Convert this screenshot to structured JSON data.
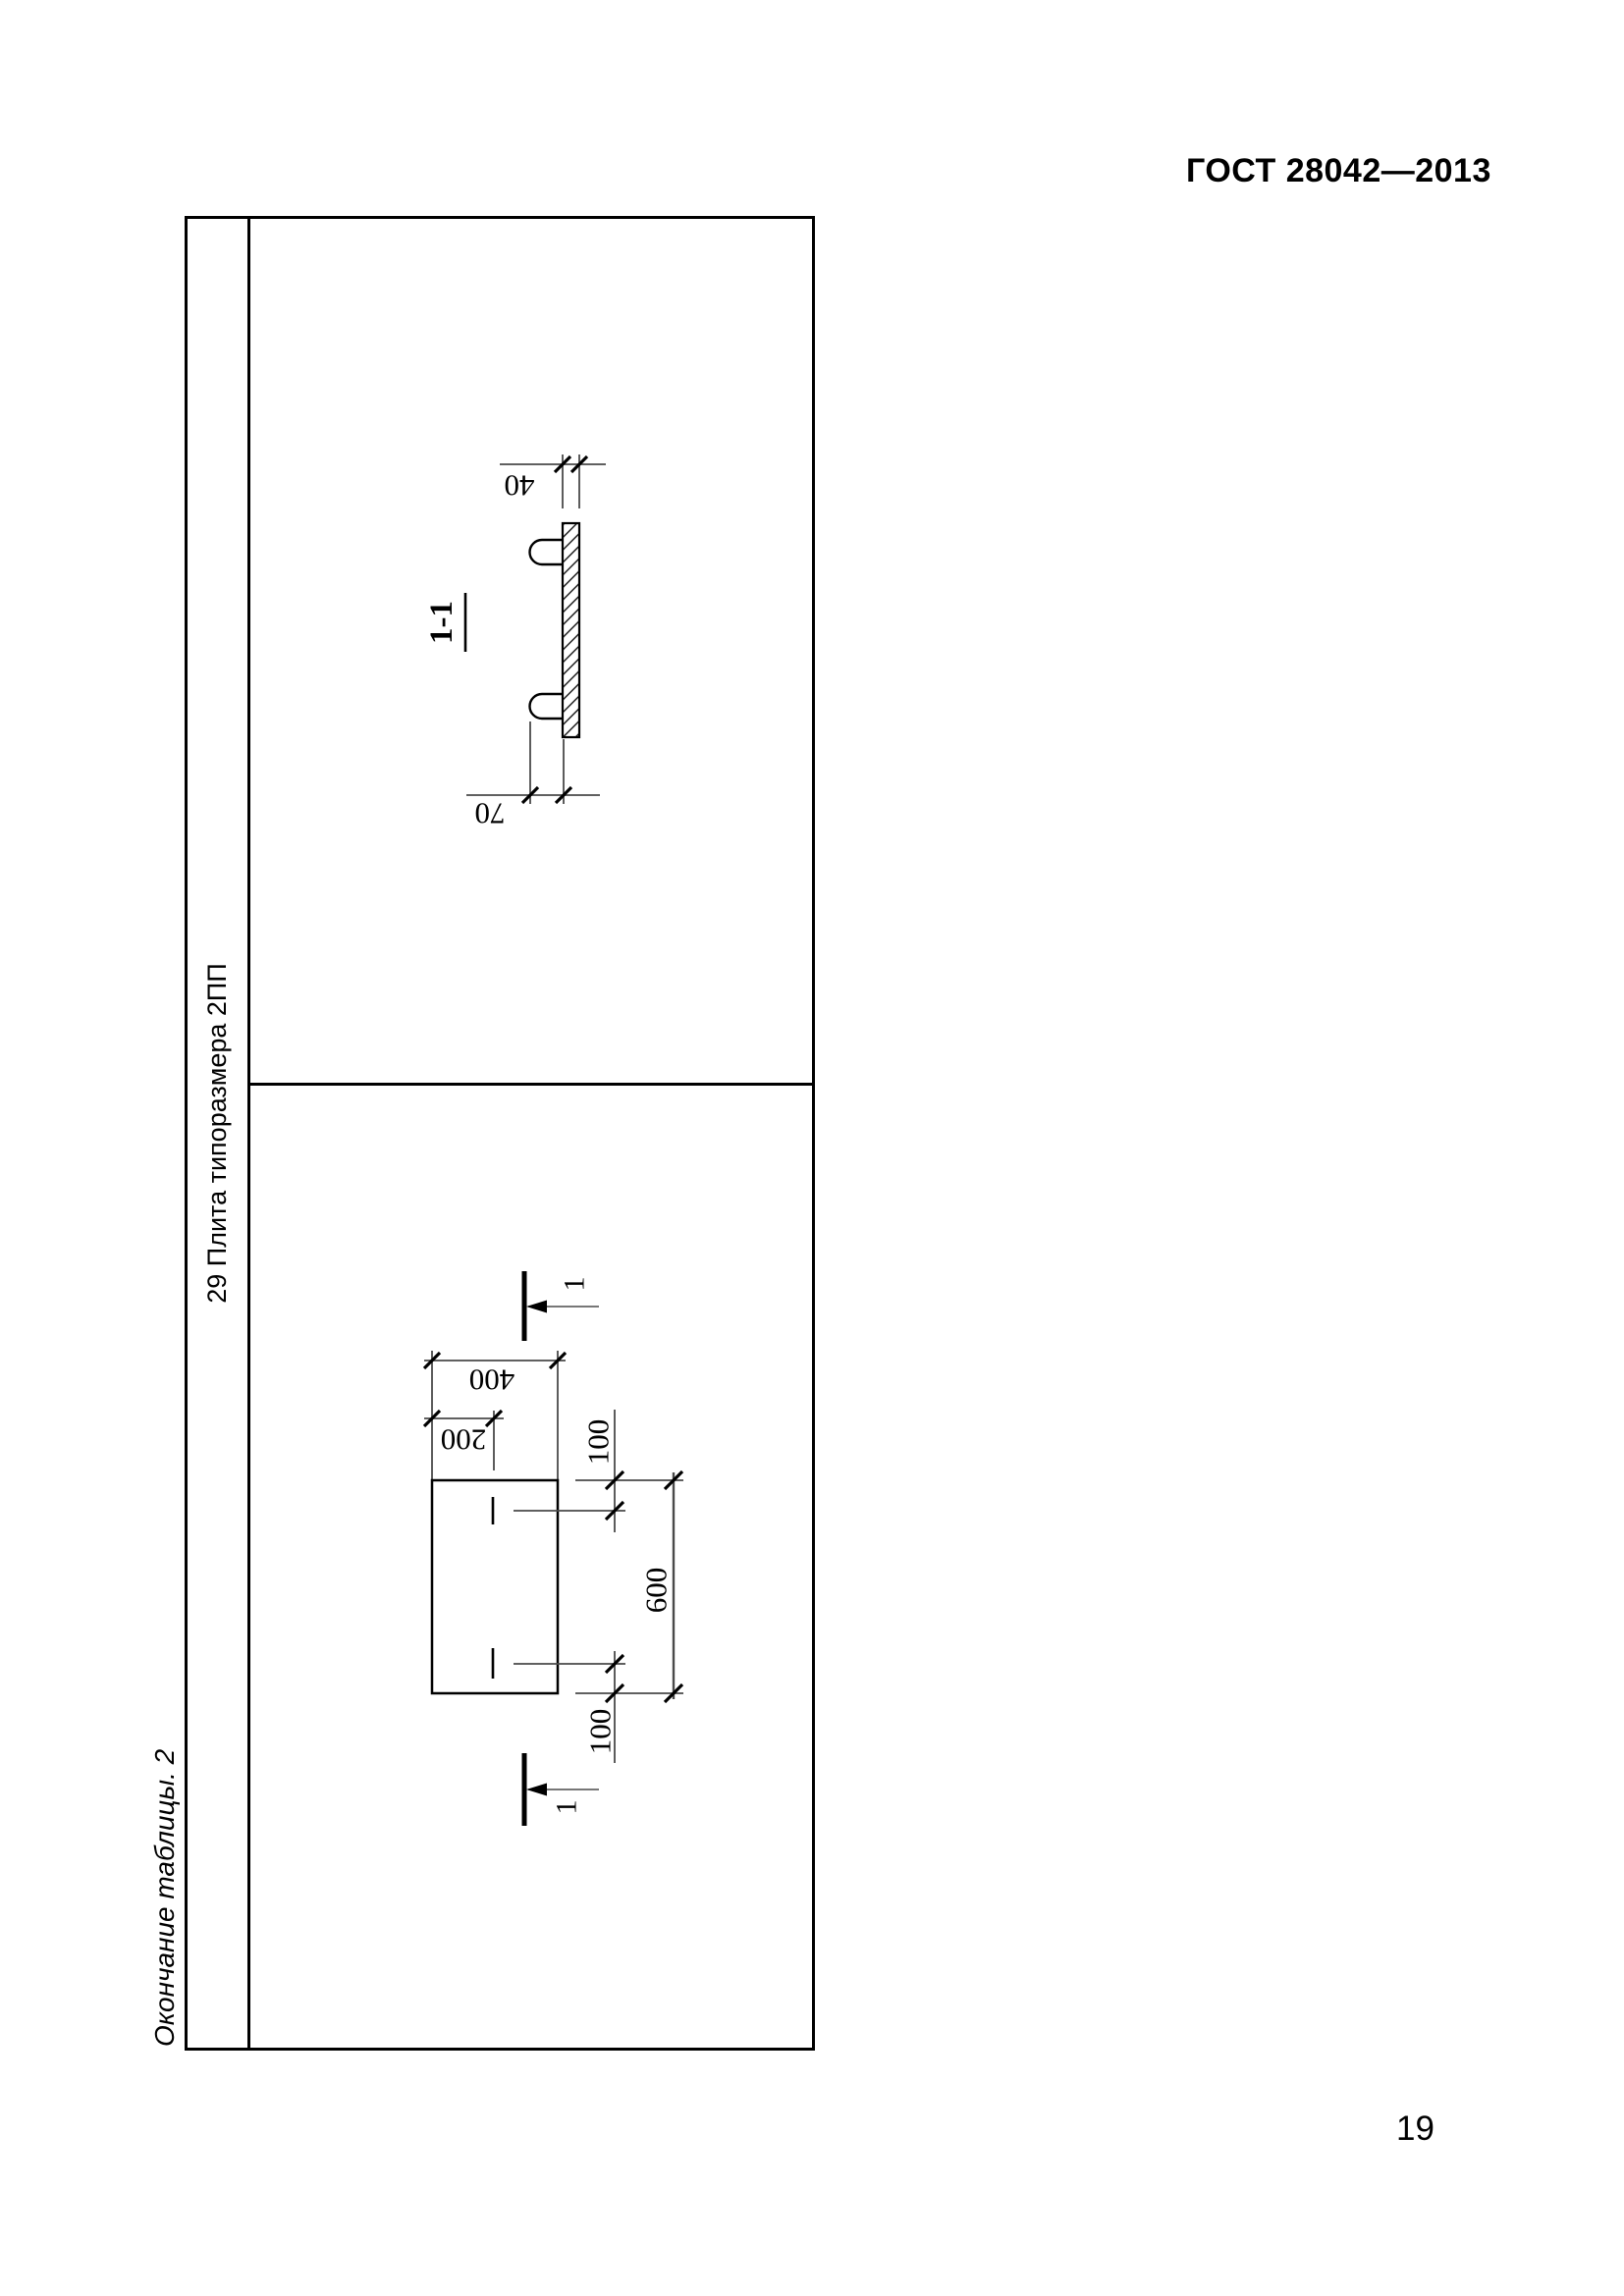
{
  "page": {
    "doc_number": "ГОСТ 28042—2013",
    "page_number": "19",
    "table_caption": "Окончание таблицы. 2"
  },
  "table": {
    "row_header": "29 Плита типоразмера 2ПП",
    "section_view": {
      "title": "1-1",
      "dim_thickness": "40",
      "dim_loop_height": "70"
    },
    "plan_view": {
      "section_label_top": "1",
      "section_label_bottom": "1",
      "dim_width": "400",
      "dim_loop_offset": "200",
      "dim_end_top": "100",
      "dim_length": "600",
      "dim_end_bottom": "100"
    }
  }
}
